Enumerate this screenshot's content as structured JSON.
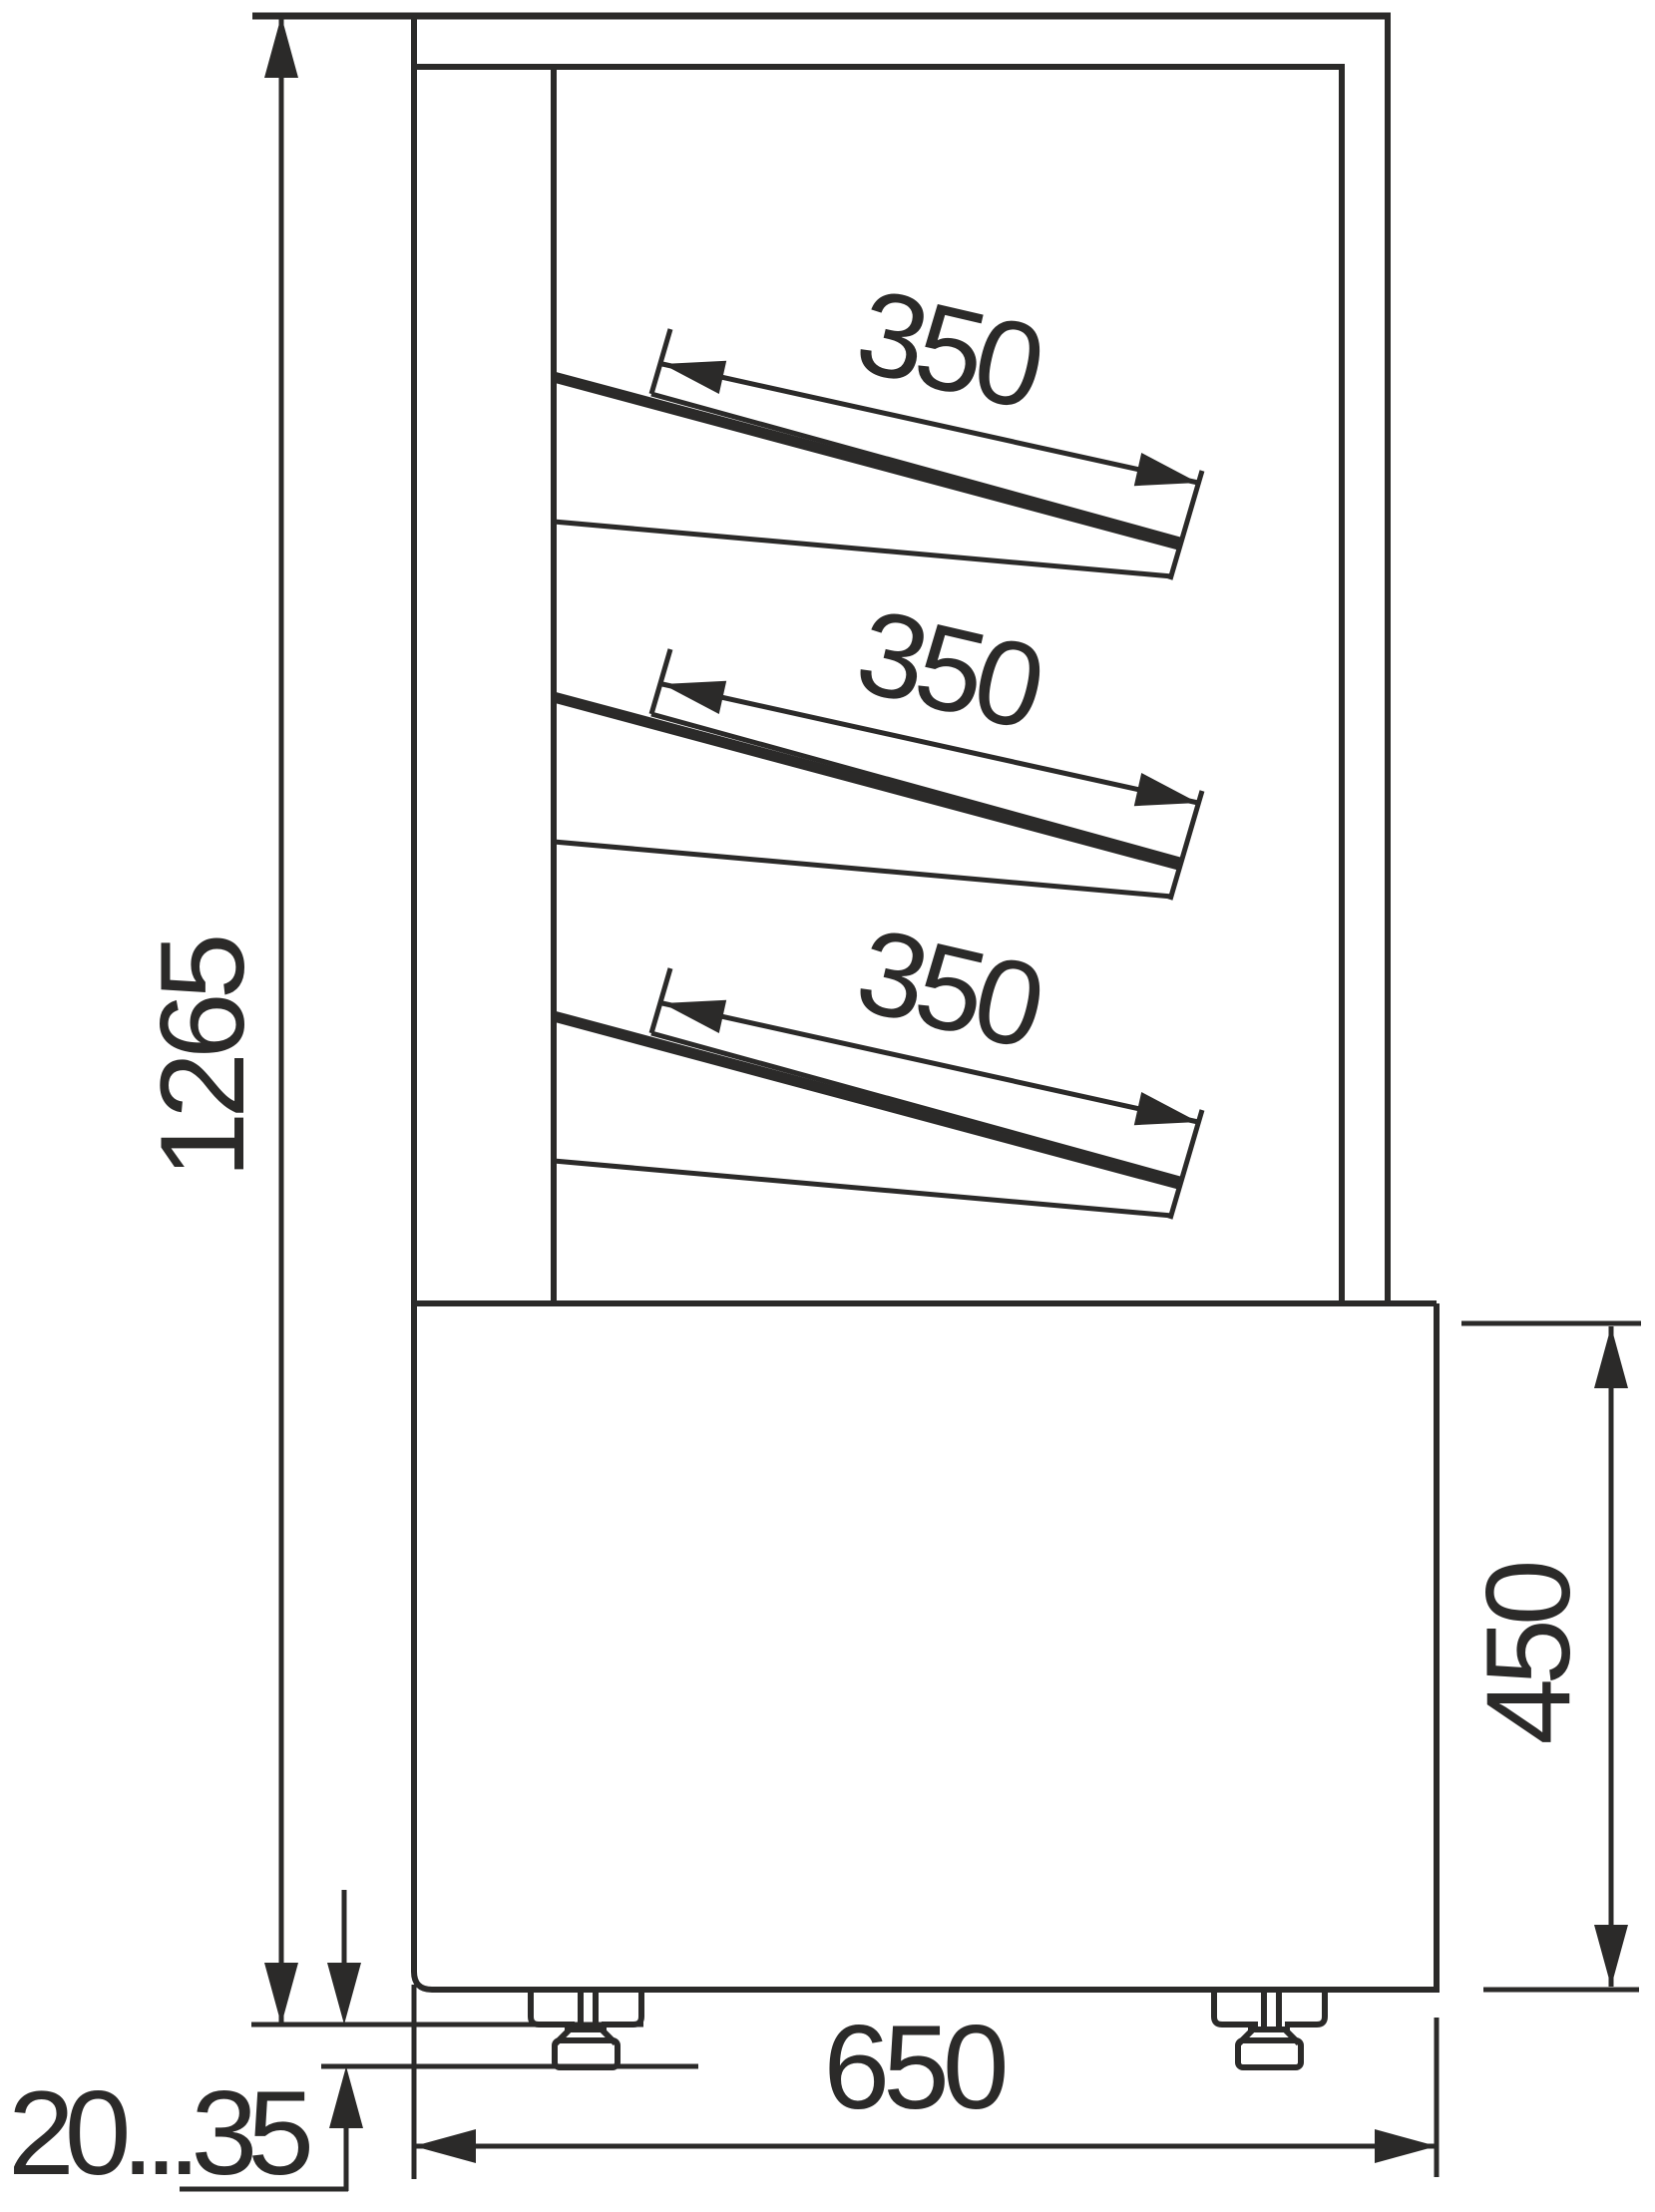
{
  "drawing": {
    "background": "#ffffff",
    "line_color": "#2b2a29",
    "labels": {
      "overall_height": "1265",
      "base_height": "450",
      "base_depth": "650",
      "leg_adjust_range": "20...35"
    },
    "shelves": [
      {
        "label": "350"
      },
      {
        "label": "350"
      },
      {
        "label": "350"
      }
    ]
  }
}
